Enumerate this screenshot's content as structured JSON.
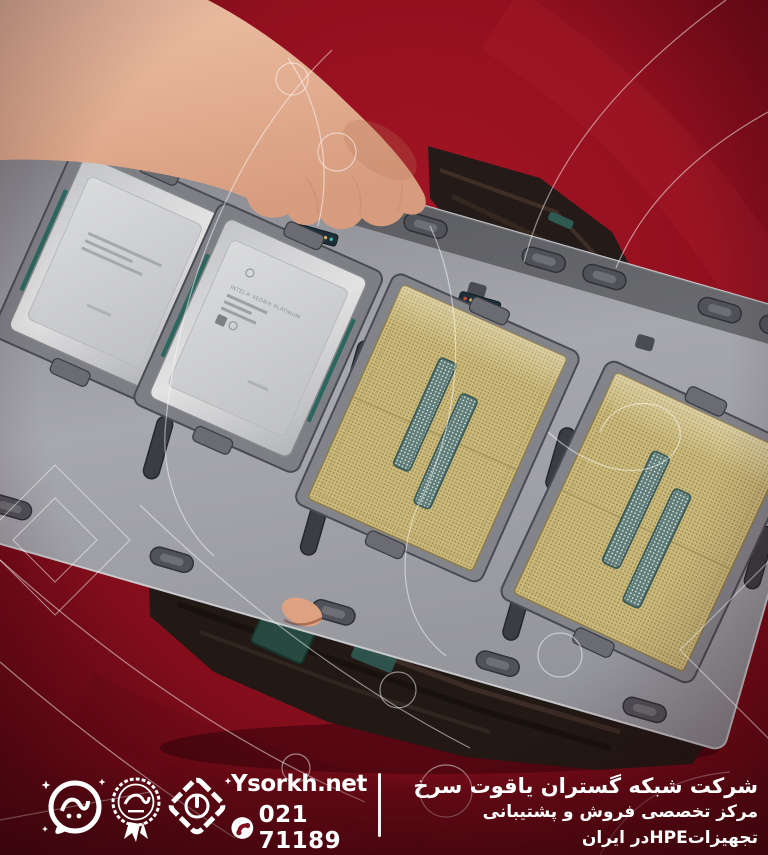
{
  "scene": {
    "subject": "Hand holding a gray plastic tray with four Intel Xeon server processors over a red backdrop; stacked dark CPU trays underneath",
    "cpu_marking": "INTEL® XEON® PLATINUM",
    "cpus": [
      {
        "position": 1,
        "side": "heat-spreader-up",
        "finish": "silver"
      },
      {
        "position": 2,
        "side": "heat-spreader-up",
        "finish": "silver",
        "marking": "INTEL® XEON® PLATINUM"
      },
      {
        "position": 3,
        "side": "contacts-up",
        "finish": "gold"
      },
      {
        "position": 4,
        "side": "contacts-up",
        "finish": "gold"
      }
    ],
    "colors": {
      "background_red": "#93101f",
      "tray_gray": "#9b9ca2",
      "cpu_silver": "#d2d3d5",
      "cpu_gold": "#cbb97a",
      "capacitor_teal": "#5f7c78",
      "skin": "#e5b295",
      "stack_dark": "#261c19",
      "watermark_white": "#ffffff"
    }
  },
  "footer": {
    "website": "Ysorkh.net",
    "phone": "021 71189",
    "company_fa": "شرکت شبکه گستران یاقوت سرخ",
    "tagline_fa": "مرکز تخصصی فروش و پشتیبانی تجهیزاتHPEدر ایران",
    "logos": [
      "speech-bubble-calligraphy-logo",
      "scalloped-seal-badge",
      "diamond-chain-emblem"
    ]
  }
}
